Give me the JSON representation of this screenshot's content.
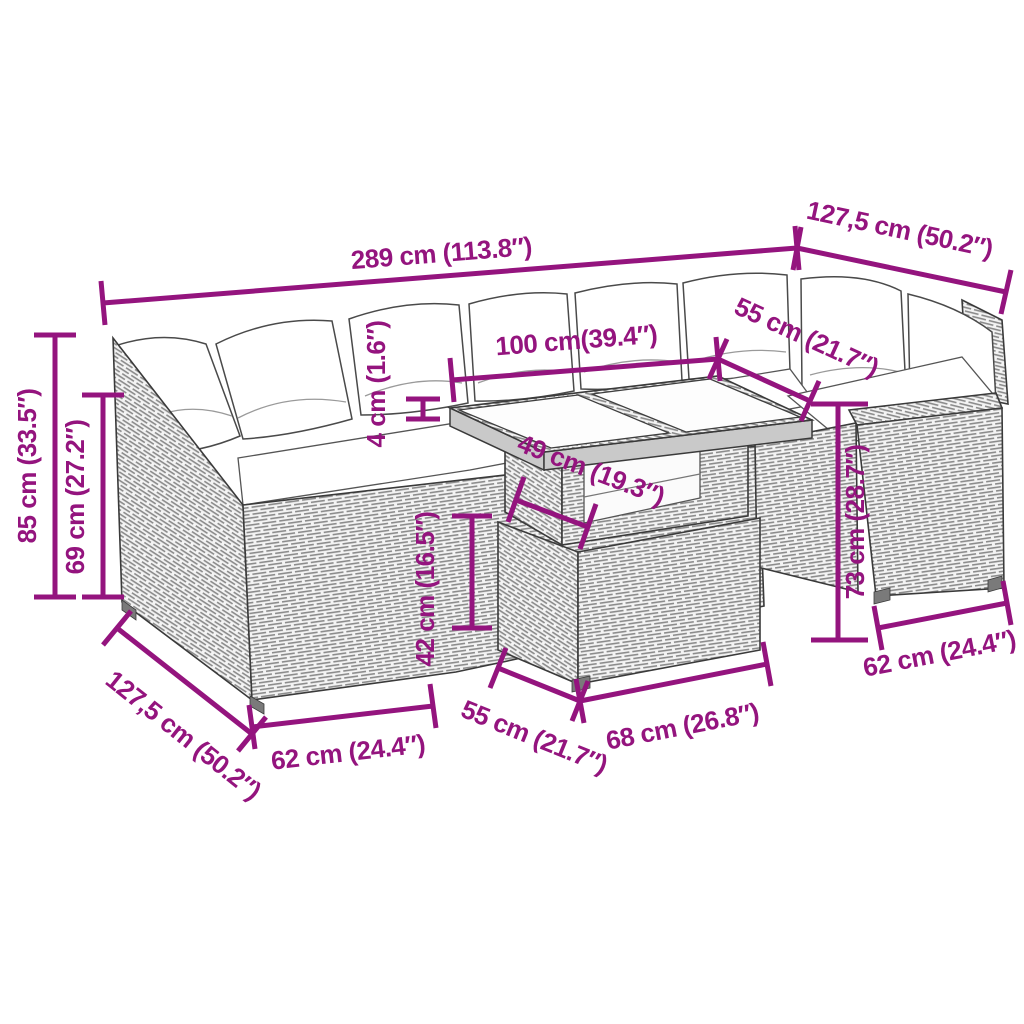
{
  "diagram": {
    "product": "rattan corner sofa set with glass-top table",
    "background": "#ffffff",
    "dimension_color": "#94147E",
    "outline_color": "#3a3a3a",
    "cushion_color": "#ffffff",
    "weave_line_color": "#8c8c8c",
    "dimensions": {
      "total_width": {
        "label": "289 cm (113.8″)"
      },
      "right_section_depth": {
        "label": "127,5 cm (50.2″)"
      },
      "total_height": {
        "label": "85 cm (33.5″)"
      },
      "frame_height": {
        "label": "69 cm (27.2″)"
      },
      "tabletop_width": {
        "label": "100 cm(39.4″)"
      },
      "tabletop_depth": {
        "label": "55 cm (21.7″)"
      },
      "tabletop_thickness": {
        "label": "4 cm (1.6″)"
      },
      "shelf_depth": {
        "label": "49 cm (19.3″)"
      },
      "table_base_height": {
        "label": "42 cm (16.5″)"
      },
      "armrest_height": {
        "label": "73 cm (28.7″)"
      },
      "right_module_width": {
        "label": "62 cm (24.4″)"
      },
      "left_section_depth": {
        "label": "127,5 cm (50.2″)"
      },
      "left_module_width": {
        "label": "62 cm (24.4″)"
      },
      "table_base_depth": {
        "label": "55 cm (21.7″)"
      },
      "table_base_width": {
        "label": "68 cm (26.8″)"
      }
    }
  }
}
